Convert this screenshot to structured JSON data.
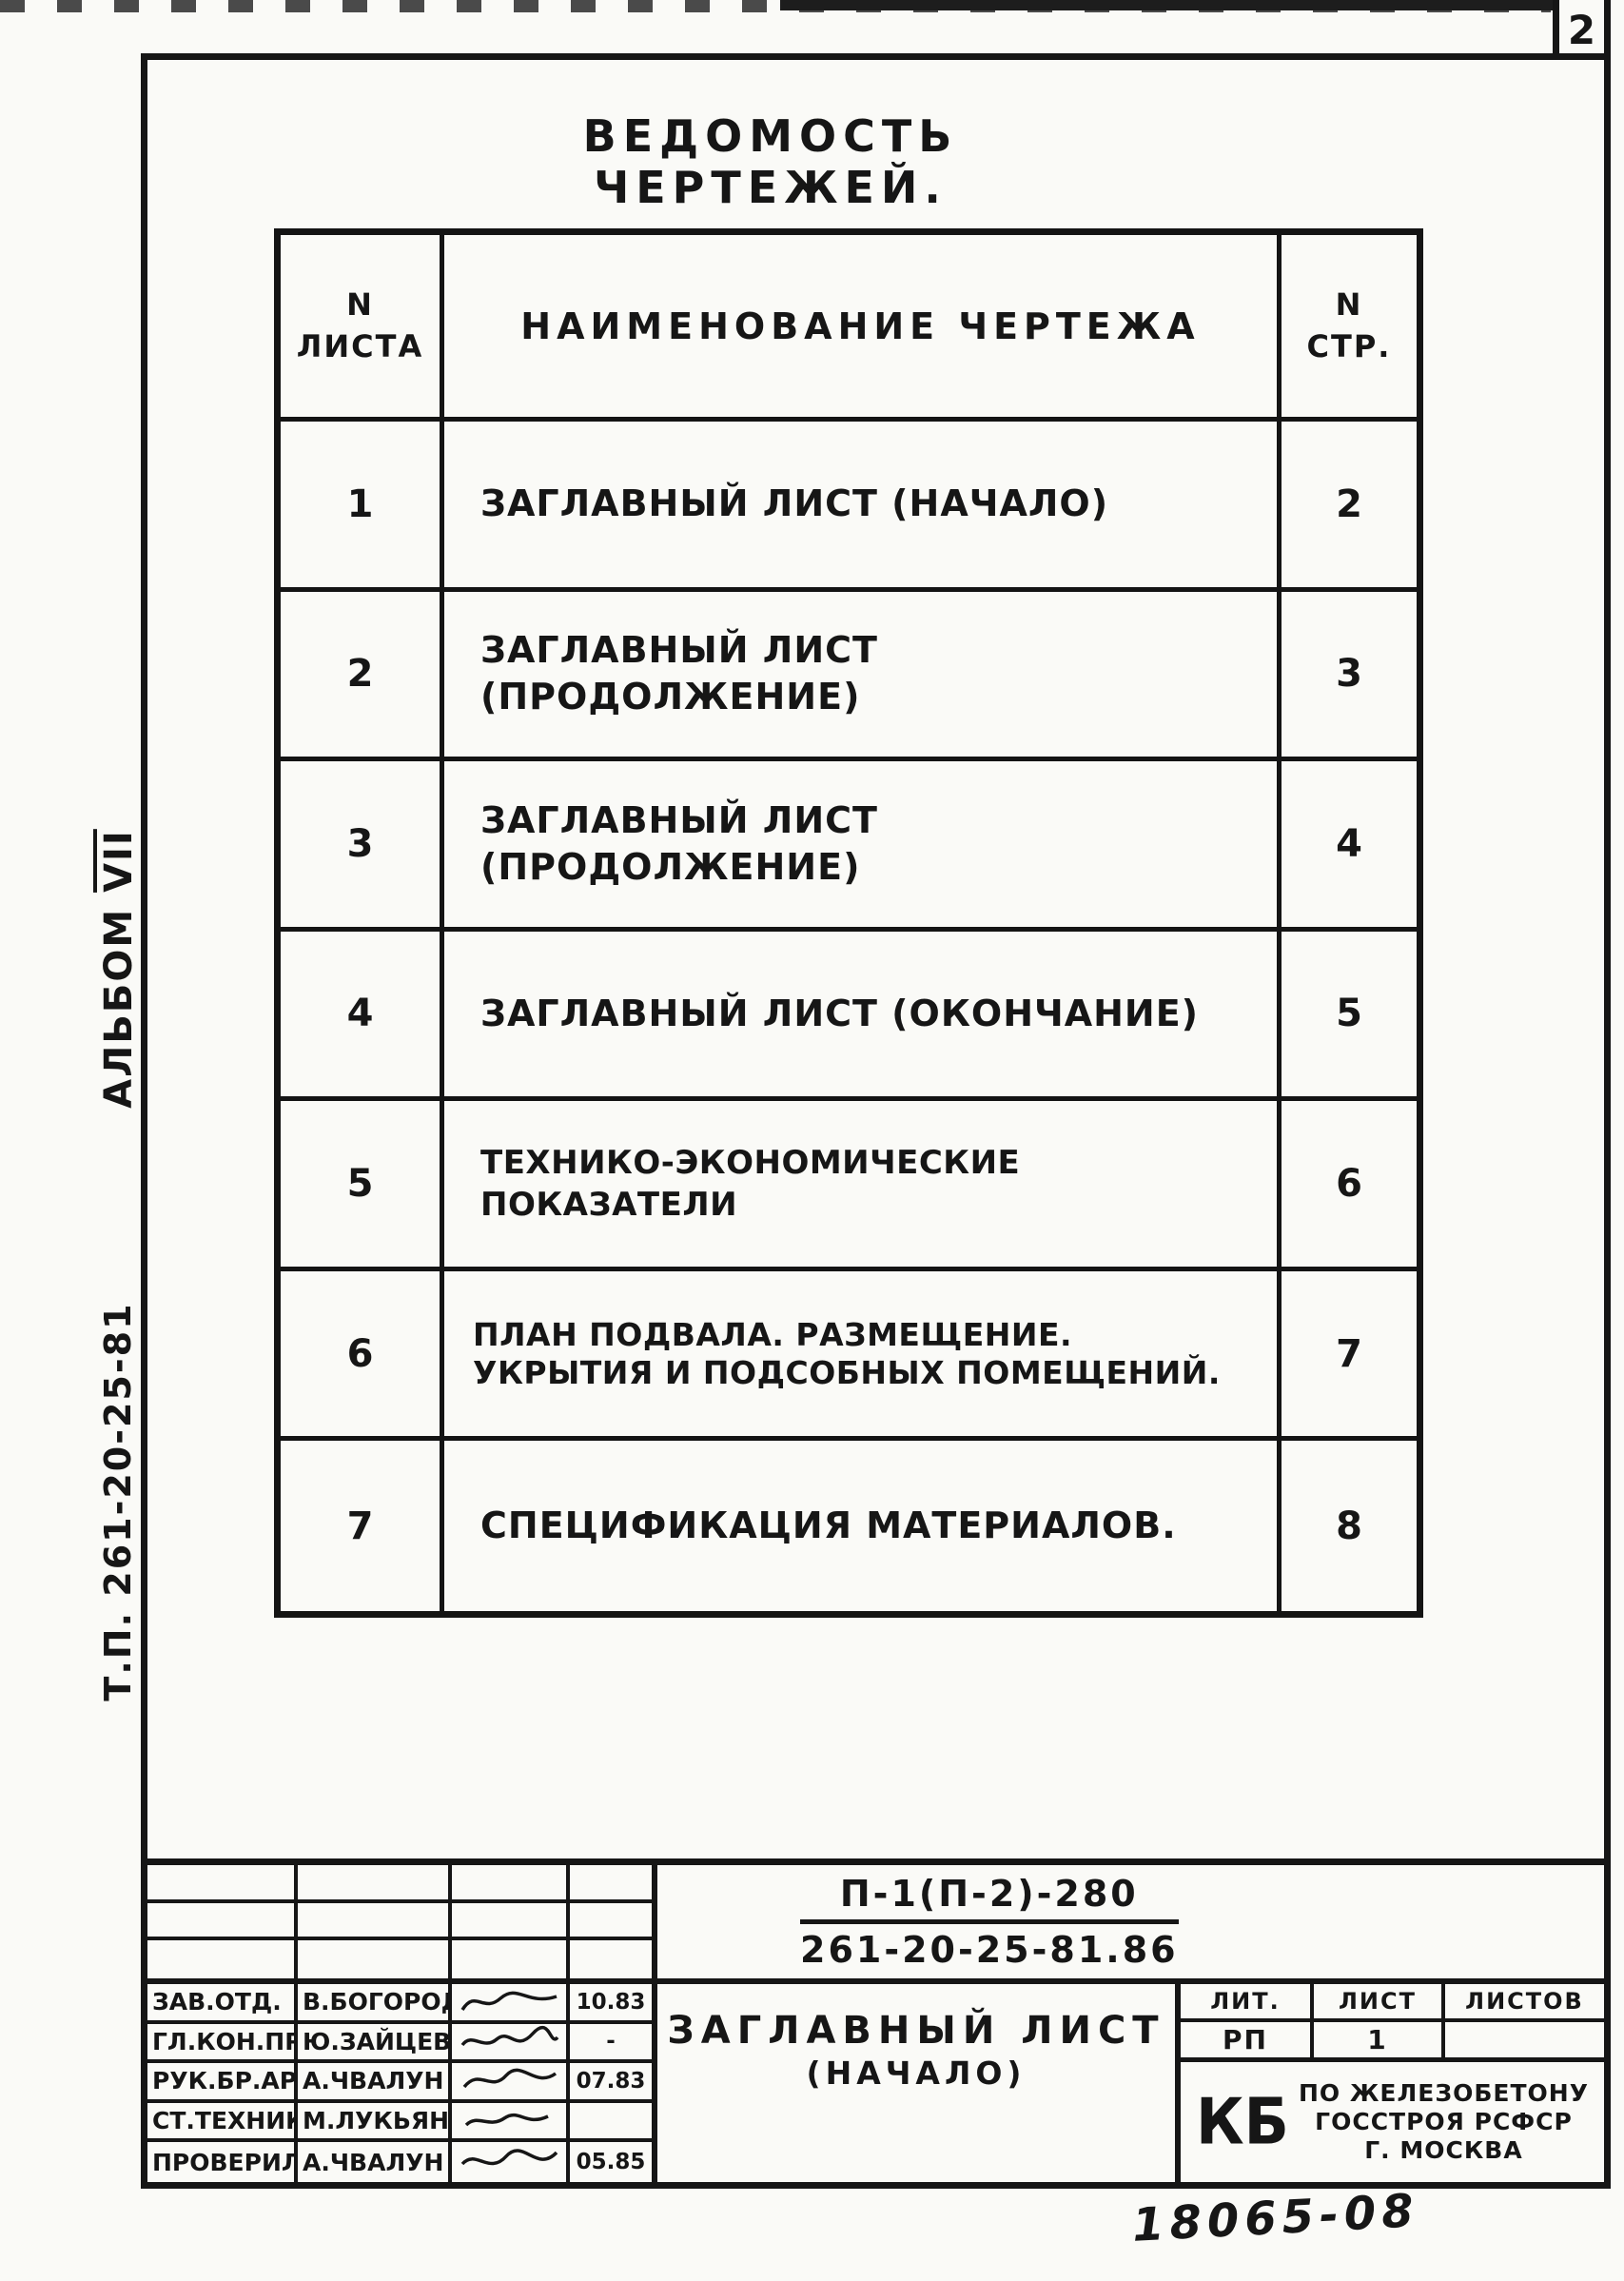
{
  "page": {
    "number": "2",
    "handwritten_number": "18065-08",
    "ink_color": "#161616",
    "paper_color": "#fafaf7",
    "side_labels": {
      "album_word": "Альбом",
      "album_numeral": "VII",
      "project": "т.п. 261-20-25-81"
    }
  },
  "drawing_list": {
    "title": "Ведомость чертежей.",
    "columns": {
      "sheet_line1": "N",
      "sheet_line2": "листа",
      "name": "Наименование чертежа",
      "page_line1": "N",
      "page_line2": "стр."
    },
    "rows": [
      {
        "sheet": "1",
        "name": "Заглавный лист (начало)",
        "page": "2"
      },
      {
        "sheet": "2",
        "name": "Заглавный лист (продолжение)",
        "page": "3"
      },
      {
        "sheet": "3",
        "name": "Заглавный лист (продолжение)",
        "page": "4"
      },
      {
        "sheet": "4",
        "name": "Заглавный лист (окончание)",
        "page": "5"
      },
      {
        "sheet": "5",
        "name": "Технико-экономические показатели",
        "page": "6"
      },
      {
        "sheet": "6",
        "name": "План подвала. Размещение. укрытия и подсобных помещений.",
        "page": "7"
      },
      {
        "sheet": "7",
        "name": "Спецификация материалов.",
        "page": "8"
      }
    ]
  },
  "title_block": {
    "doc_code_top": "П-1(П-2)-280",
    "doc_code_bottom": "261-20-25-81.86",
    "drawing_title_line1": "Заглавный лист",
    "drawing_title_line2": "(начало)",
    "stage_headers": {
      "lit": "Лит.",
      "list": "Лист",
      "listov": "Листов"
    },
    "stage_values": {
      "lit": "РП",
      "list": "1",
      "listov": ""
    },
    "organization": {
      "logo": "КБ",
      "line1": "по железобетону",
      "line2": "Госстроя РСФСР",
      "line3": "г. Москва"
    },
    "signatures": [
      {
        "role": "Зав.отд.",
        "name": "В.Богородская",
        "date": "10.83"
      },
      {
        "role": "Гл.кон.пр.",
        "name": "Ю.Зайцев",
        "date": "-"
      },
      {
        "role": "Рук.бр.Арх",
        "name": "А.Чвалун",
        "date": "07.83"
      },
      {
        "role": "Ст.техник",
        "name": "М.Лукьянов",
        "date": ""
      },
      {
        "role": "Проверил",
        "name": "А.Чвалун",
        "date": "05.85"
      }
    ]
  }
}
